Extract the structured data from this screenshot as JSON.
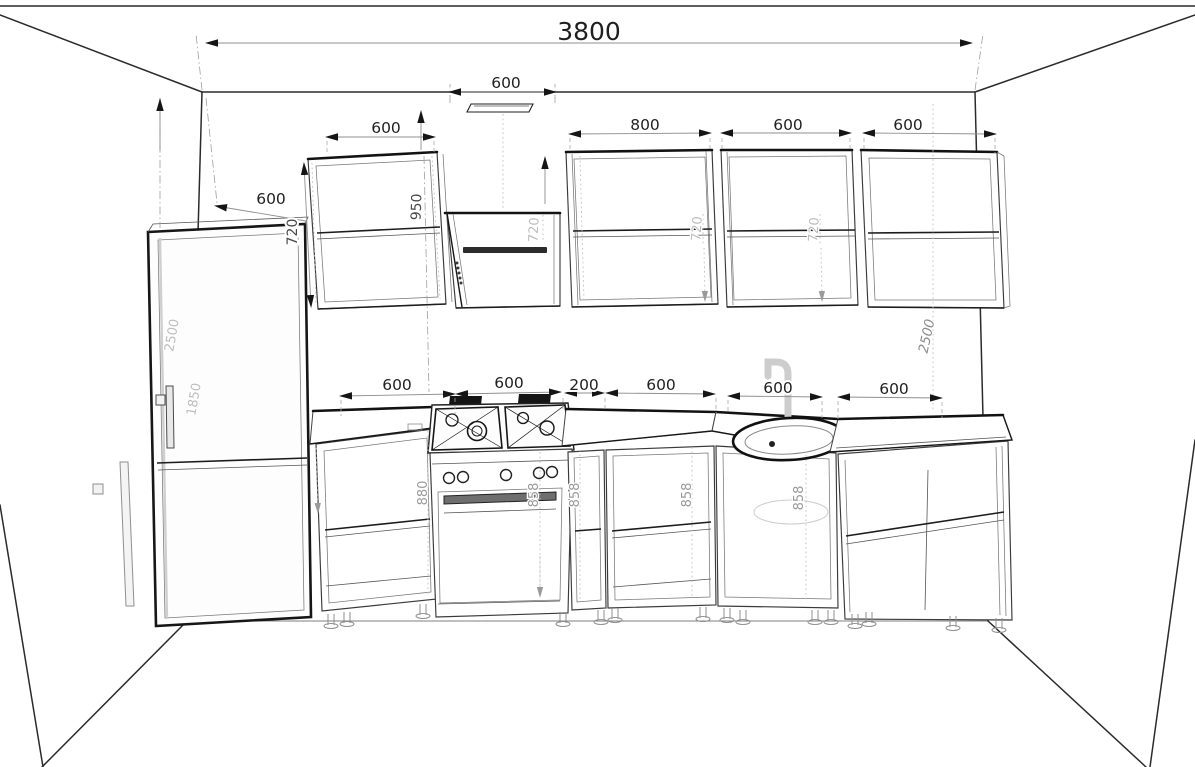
{
  "drawing_title": "kitchen-elevation-drawing",
  "colors": {
    "background": "#ffffff",
    "line": "#2b2b2b",
    "dim_text": "#1f1f1f",
    "light_label": "#bdbdbd",
    "mid_label": "#9a9a9a"
  },
  "labels": {
    "total_width": "3800",
    "hood_width": "600",
    "fridge_width": "600",
    "upper_left_cabinet_width": "600",
    "upper_cabinet_800_width": "800",
    "upper_cabinet_a_width": "600",
    "upper_cabinet_b_width": "600",
    "upper_left_cabinet_side": "720",
    "upper_left_cabinet_height": "950",
    "hood_cabinet_height": "720",
    "upper_cabinet_a_height": "720",
    "upper_cabinet_b_height": "720",
    "room_height_left": "2500",
    "room_height_right": "2500",
    "fridge_height": "1850",
    "base_widths": [
      "600",
      "600",
      "200",
      "600",
      "600",
      "600"
    ],
    "base_height_left": "880",
    "base_heights_858": [
      "858",
      "858",
      "858",
      "858"
    ]
  }
}
